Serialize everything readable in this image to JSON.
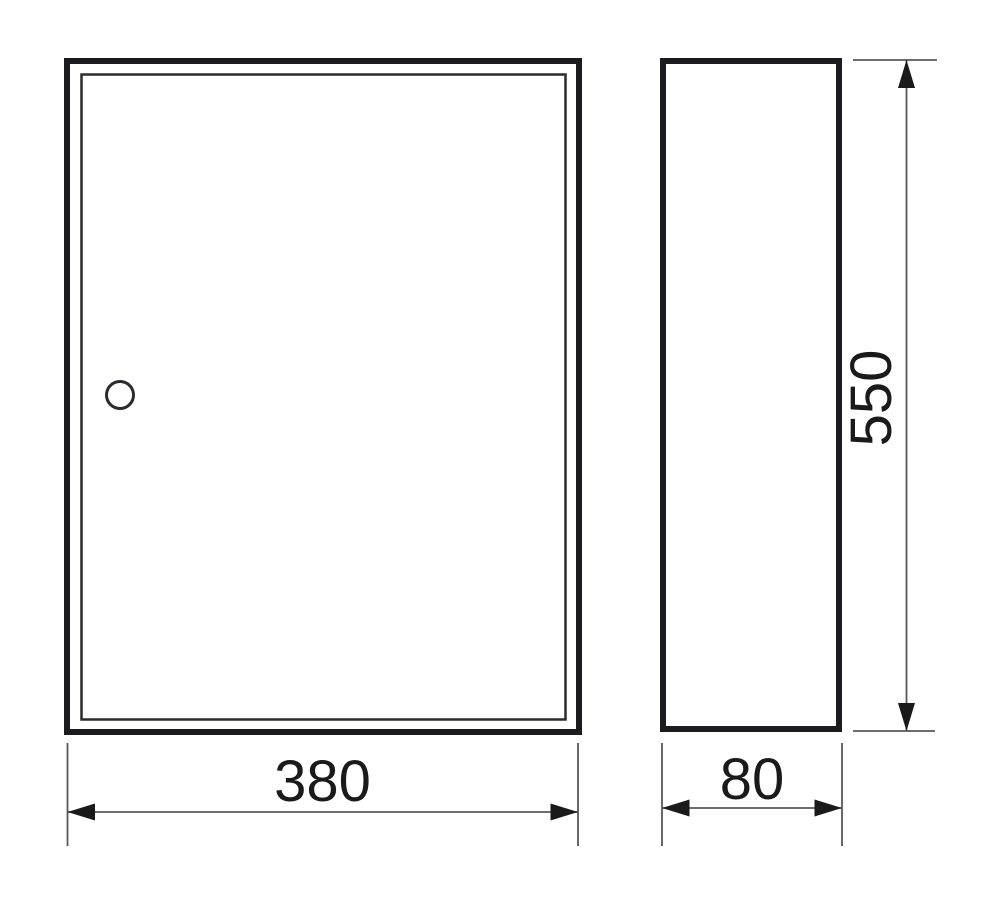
{
  "drawing": {
    "kind": "technical-dimension-drawing",
    "views": {
      "front": "front-view",
      "side": "side-view"
    },
    "icons": {
      "keyhole": "circle-outline"
    },
    "dimensions": {
      "width": {
        "value": "380"
      },
      "height": {
        "value": "550"
      },
      "depth": {
        "value": "80"
      }
    },
    "colors": {
      "background": "#ffffff",
      "outline": "#1c1c20",
      "inner_outline": "#2b2b2f",
      "dimension_line": "#58585a",
      "arrow": "#1a1a1a",
      "text": "#1a1a1a"
    }
  }
}
